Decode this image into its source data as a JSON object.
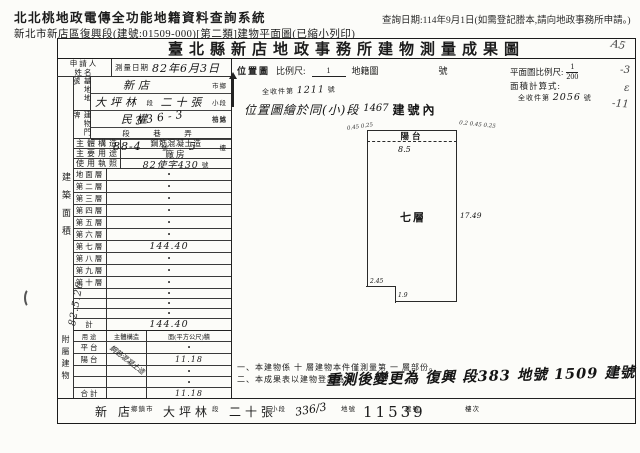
{
  "header": {
    "system_title": "北北桃地政電傳全功能地籍資料查詢系統",
    "doc_subtitle": "新北市新店區復興段(建號:01509-000)[第二類]建物平面圖(已縮小列印)",
    "query_date": "查詢日期:114年9月1日(如需登記謄本,請向地政事務所申請。)"
  },
  "form": {
    "title": "臺北縣新店地政事務所建物測量成果圖",
    "applicant_label": "申請人姓名",
    "survey_date_label": "測量日期",
    "survey_date_value": "82年6月3日",
    "site": {
      "label": "基地地號",
      "city_value": "新店",
      "city_suffix": "市鄉",
      "sec_value": "大坪林",
      "sec_suffix": "段",
      "subsec_value": "二十張",
      "subsec_suffix": "小段",
      "lot_value": "336-3",
      "lot_suffix": "地號"
    },
    "address": {
      "label": "建物門牌",
      "street_value": "民權",
      "street_suffix": "街路",
      "unit_row": "段　巷　弄",
      "no_value": "88-4",
      "no_suffix": "號",
      "floor_value": "5",
      "floor_suffix": "樓"
    },
    "structure_label": "主體構造",
    "structure_value": "鋼筋混凝土造",
    "usage_label": "主要用途",
    "usage_value": "廠房",
    "license_label": "使用執照",
    "license_value": "82使字430",
    "license_suffix": "號",
    "floor_area": {
      "side_label": "建築面積",
      "rows": [
        {
          "label": "地面層",
          "value": "•"
        },
        {
          "label": "第二層",
          "value": "•"
        },
        {
          "label": "第三層",
          "value": "•"
        },
        {
          "label": "第四層",
          "value": "•"
        },
        {
          "label": "第五層",
          "value": "•"
        },
        {
          "label": "第六層",
          "value": "•"
        },
        {
          "label": "第七層",
          "value": "144.40"
        },
        {
          "label": "第八層",
          "value": "•"
        },
        {
          "label": "第九層",
          "value": "•"
        },
        {
          "label": "第十層",
          "value": "•"
        },
        {
          "label": "",
          "value": "•"
        },
        {
          "label": "",
          "value": "•"
        },
        {
          "label": "",
          "value": "•"
        },
        {
          "label": "計",
          "value": "144.40"
        }
      ]
    },
    "attached": {
      "side_label": "附屬建物",
      "col_use": "用途",
      "col_structure": "主體構造",
      "col_area": "面(平方公尺)積",
      "rows": [
        {
          "label": "平台",
          "structure": "",
          "value": "•"
        },
        {
          "label": "陽台",
          "structure": "鋼筋混凝土造",
          "value": "11.18"
        },
        {
          "label": "",
          "structure": "",
          "value": "•"
        },
        {
          "label": "",
          "structure": "",
          "value": "•"
        },
        {
          "label": "合計",
          "structure": "",
          "value": "11.18"
        }
      ]
    },
    "location_map": {
      "label": "位置圖",
      "scale_label": "比例尺:",
      "scale_numerator": "1",
      "cadastral_label": "地籍圖",
      "no_label": "號",
      "receipt_prefix": "全收件第",
      "receipt_no": "1211",
      "receipt_suffix": "號",
      "note_hand": "位置圖繪於同(小)段",
      "note_no": "1467",
      "note_suffix": "建號內"
    },
    "plan_map": {
      "scale_label": "平面圖比例尺:",
      "scale_numerator": "1",
      "scale_denominator": "200",
      "calc_label": "面積計算式:",
      "receipt_prefix": "全收件第",
      "receipt_no": "2056",
      "receipt_suffix": "號"
    },
    "drawing": {
      "balcony_label": "陽台",
      "width_dim": "8.5",
      "room_label": "七層",
      "height_dim": "17.49",
      "notch_width": "2.45",
      "notch_height": "1.9",
      "corner_left_marks": "0.45 0.25",
      "corner_right_marks": "0.2 0.45 0.25"
    },
    "notes": {
      "line1": "一、本建物係 十 層建物本件僅測量第 一 層部份。",
      "line2": "二、本成果表以建物登記為準。",
      "handwritten": "重測後變更為 復興 段383 地號 1509 建號"
    },
    "footer_strip": {
      "items": [
        {
          "value": "新 店",
          "suffix": "鄉鎮市"
        },
        {
          "value": "大坪林",
          "suffix": "段"
        },
        {
          "value": "二十張",
          "suffix": "小段"
        },
        {
          "value": "336/3",
          "suffix": "地號"
        },
        {
          "value": "11539",
          "suffix": "建號"
        },
        {
          "value": "",
          "suffix": "樓次"
        }
      ]
    },
    "margin_notes": {
      "left_date": "82.5.26",
      "right1": "A5",
      "right2": "-3",
      "right3": "ε",
      "right4": "-11"
    }
  }
}
